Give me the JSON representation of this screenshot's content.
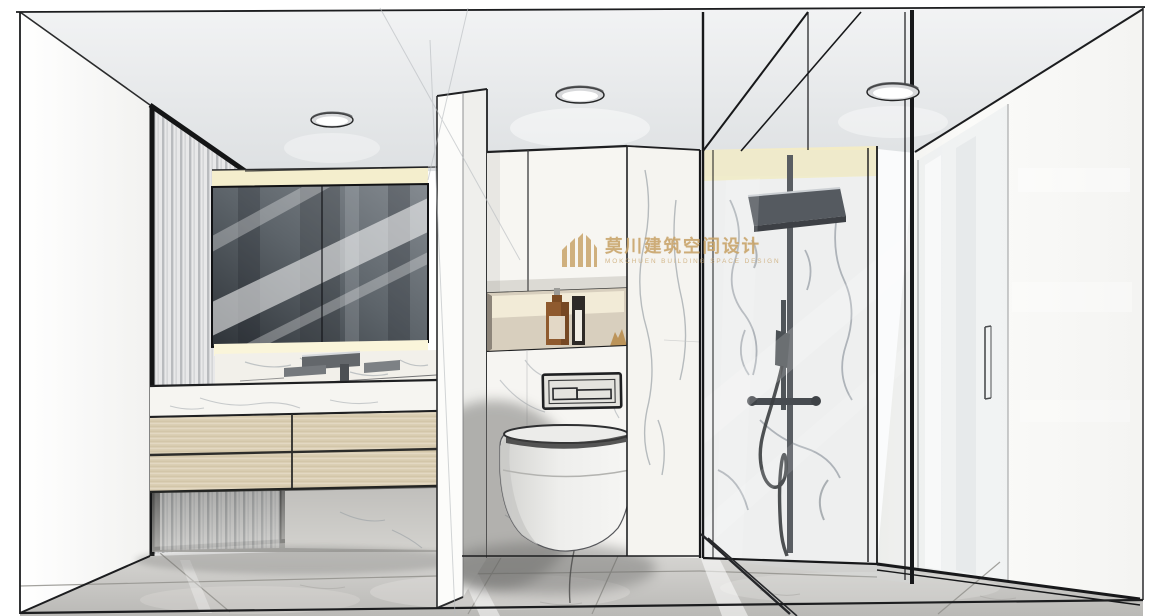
{
  "watermark": {
    "brand_cn": "莫川建筑空间设计",
    "brand_en": "MOKCHUEN BUILDING SPACE DESIGN"
  },
  "colors": {
    "gold": "#c8a368",
    "line": "#1c1d1f",
    "ceiling_top": "#f1f2f3",
    "ceiling_bottom": "#dde0e2",
    "wall_white": "#fafaf8",
    "marble_vein": "#9aa1a8",
    "wood": "#dacdb2",
    "led_cream": "#f3ecc5",
    "mirror_dark": "#363b41",
    "floor_light": "#d8d7d4",
    "floor_dark": "#bcbbb8",
    "fixture_dark": "#3c4045",
    "amber_bottle": "#8f5a2e",
    "toilet_shadow": "#6f6f6d"
  }
}
